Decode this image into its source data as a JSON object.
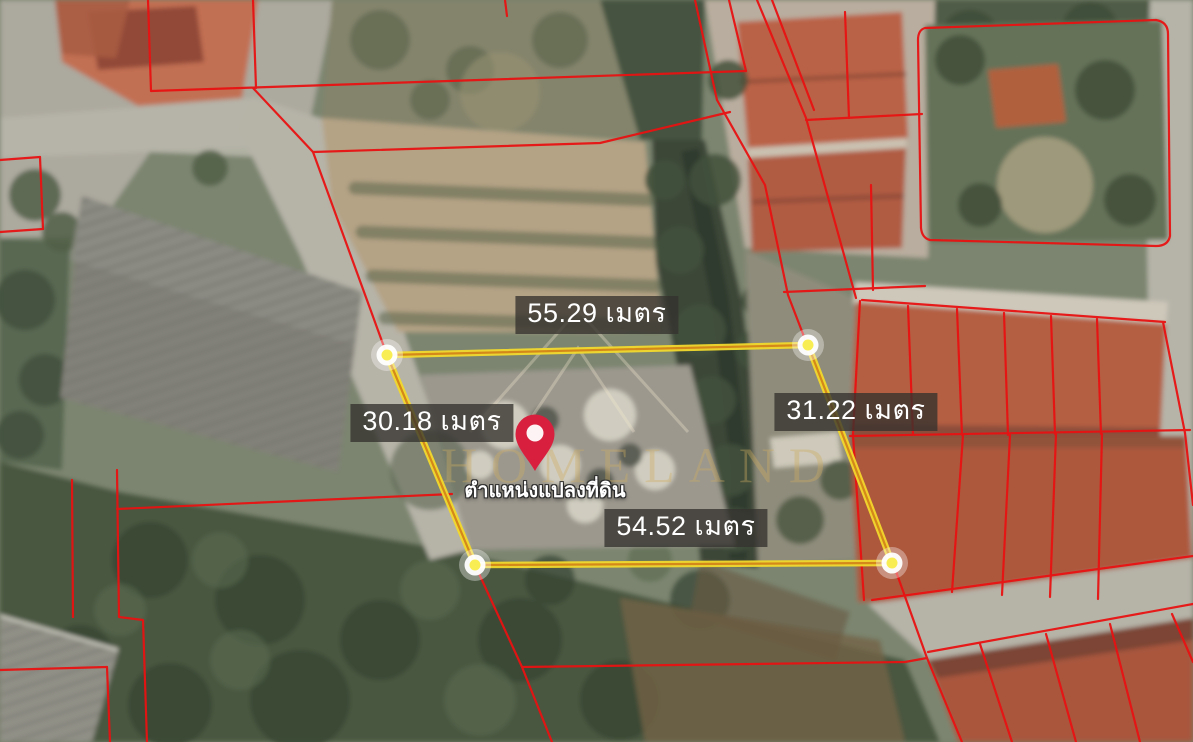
{
  "map": {
    "view": "satellite-land-plot",
    "watermark": {
      "text": "HOMELAND",
      "color": "rgba(208,174,96,0.38)",
      "logo": "mountain-peaks"
    },
    "parcel": {
      "pin_label": "ตำแหน่งแปลงที่ดิน",
      "unit": "เมตร",
      "measurements": {
        "top": "55.29 เมตร",
        "left": "30.18 เมตร",
        "right": "31.22 เมตร",
        "bottom": "54.52 เมตร"
      },
      "side_lengths_m": {
        "top": 55.29,
        "left": 30.18,
        "right": 31.22,
        "bottom": 54.52
      }
    },
    "colors": {
      "plot_outline": "#f2d92c",
      "plot_outline_core": "#d4881a",
      "vertex_fill": "#f8ee54",
      "cadastral_line": "#e81212",
      "pin": "#d91f3e",
      "label_bg": "rgba(52,50,46,0.78)",
      "label_text": "#ffffff"
    }
  }
}
